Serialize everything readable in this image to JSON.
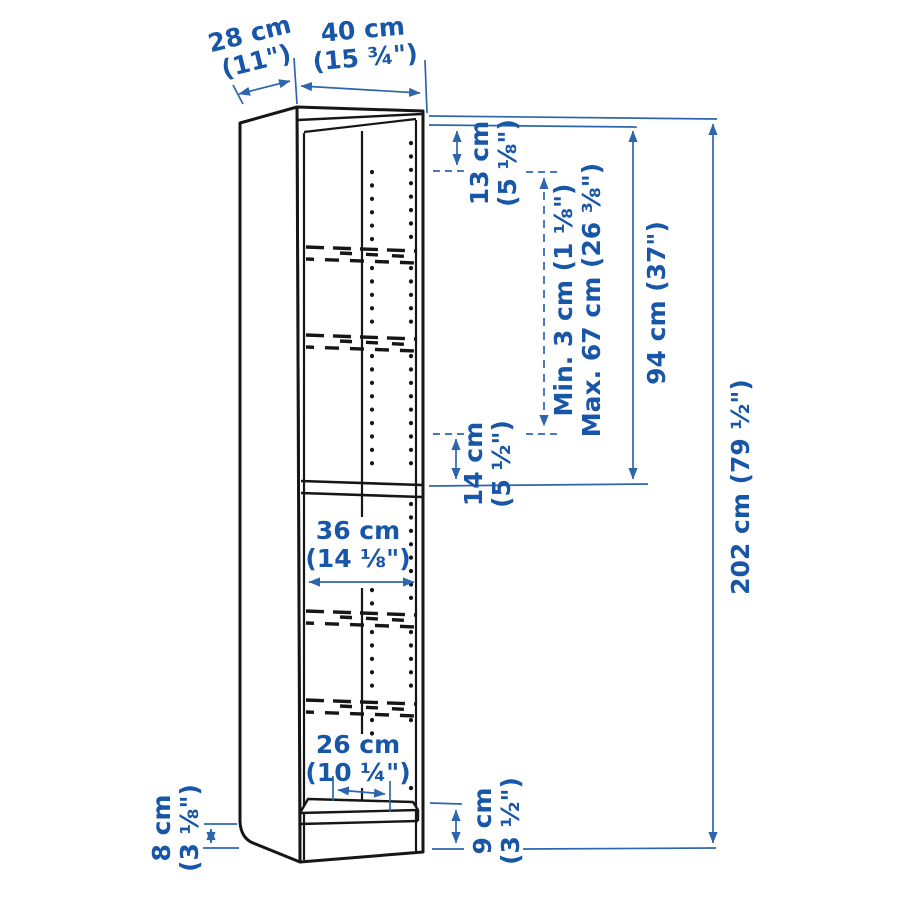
{
  "diagram": {
    "title": "bookcase-dimension-diagram",
    "colors": {
      "label_blue": "#1856a7",
      "dimension_line_blue": "#2e66ad",
      "outline_black": "#161616",
      "background": "#ffffff"
    },
    "dimensions": {
      "depth": {
        "metric": "28 cm",
        "imperial": "(11\")"
      },
      "width": {
        "metric": "40 cm",
        "imperial": "(15 ¾\")"
      },
      "top_shelf_gap": {
        "metric": "13 cm",
        "imperial": "(5 ⅛\")"
      },
      "shelf_spacing_range": {
        "min": "Min. 3 cm (1 ⅛\")",
        "max": "Max. 67 cm (26 ⅜\")"
      },
      "upper_section_height": {
        "value": "94 cm (37\")"
      },
      "total_height": {
        "value": "202 cm (79 ½\")"
      },
      "middle_shelf_gap": {
        "metric": "14 cm",
        "imperial": "(5 ½\")"
      },
      "interior_width": {
        "metric": "36 cm",
        "imperial": "(14 ⅛\")"
      },
      "bottom_shelf_depth": {
        "metric": "26 cm",
        "imperial": "(10 ¼\")"
      },
      "side_plinth_height": {
        "metric": "8 cm",
        "imperial": "(3 ⅛\")"
      },
      "front_plinth_height": {
        "metric": "9 cm",
        "imperial": "(3 ½\")"
      }
    }
  }
}
